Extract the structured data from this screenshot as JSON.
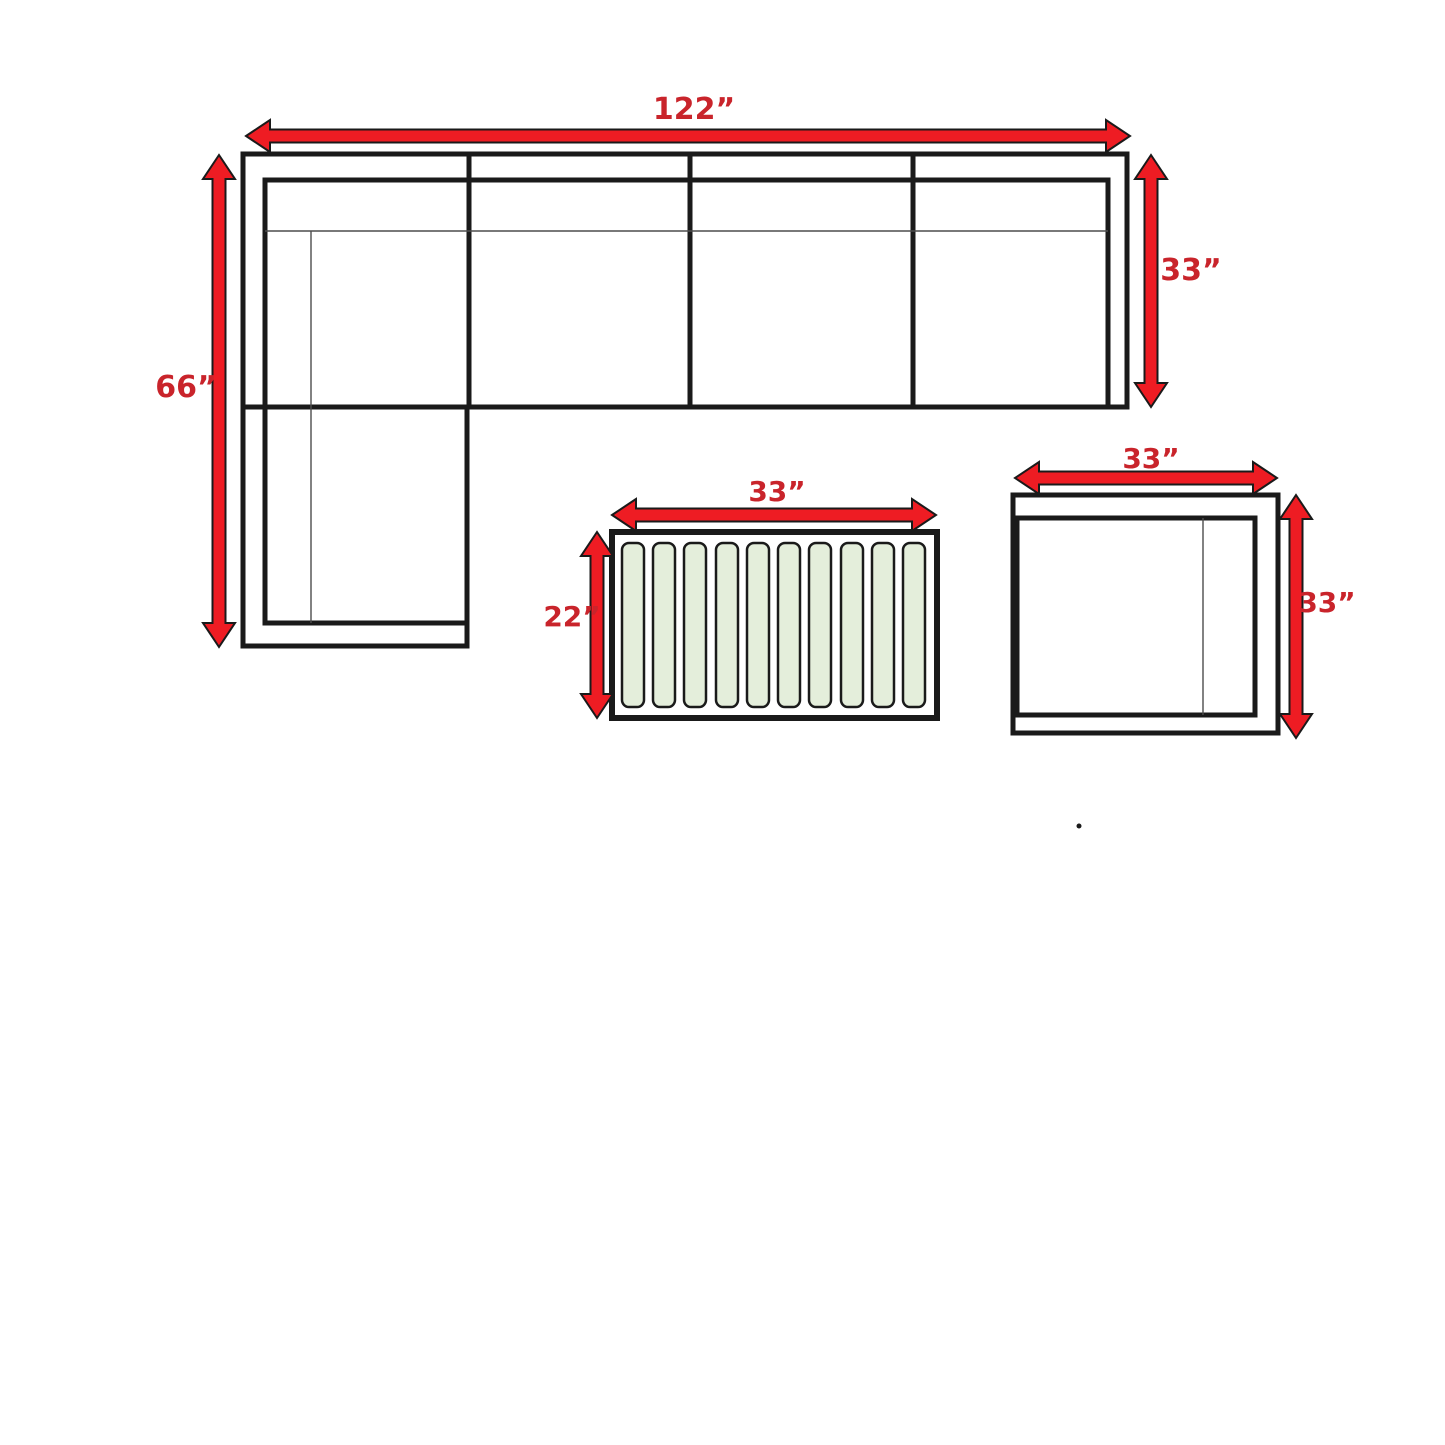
{
  "diagram": {
    "type": "furniture-dimension-plan",
    "labels": {
      "sectional_width": "122”",
      "sectional_depth": "33”",
      "sectional_length": "66”",
      "coffee_table_width": "33”",
      "coffee_table_depth": "22”",
      "side_table_width": "33”",
      "side_table_depth": "33”"
    },
    "pieces": {
      "sectional_sofa": {
        "shape": "L-shaped sectional, top view",
        "seat_sections": 4,
        "chaise_position": "bottom-left"
      },
      "coffee_table": {
        "shape": "rectangle, top view",
        "slat_count": 10
      },
      "side_table": {
        "shape": "square chair/table, top view"
      }
    },
    "colors": {
      "arrow_red": "#ee1c23",
      "label_red": "#c9242b",
      "line_black": "#1a1a1a",
      "thin_line": "#4d4d4d",
      "slat_green": "#e4eedb",
      "background": "#ffffff"
    }
  }
}
